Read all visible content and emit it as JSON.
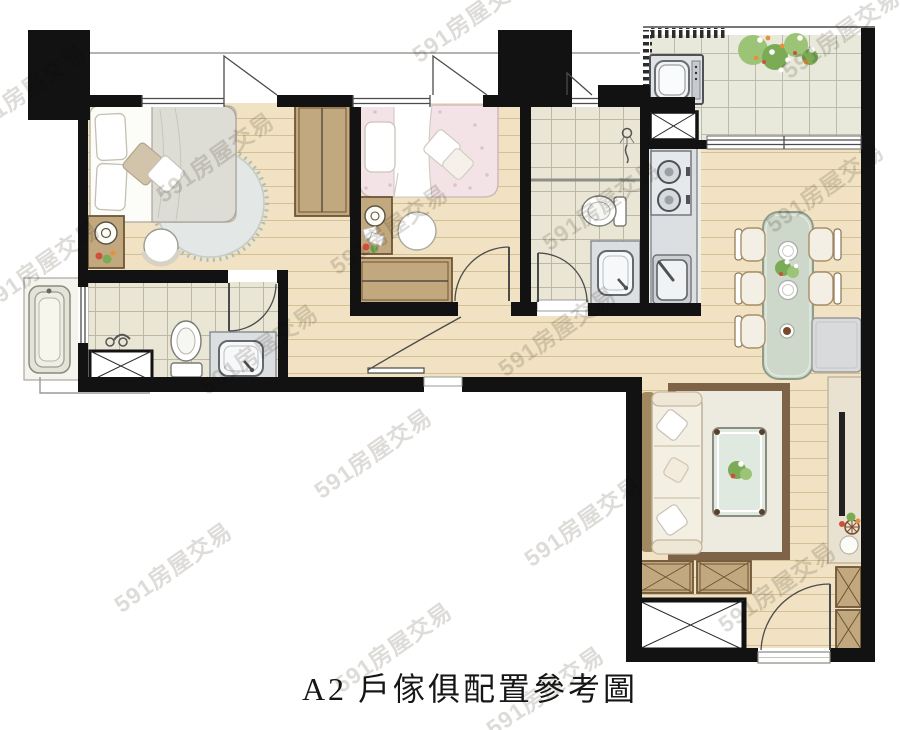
{
  "caption": "A2 戶傢俱配置參考圖",
  "watermark": {
    "text": "591房屋交易"
  },
  "palette": {
    "wall": "#121212",
    "line": "#4b4b4b",
    "thin": "#9b9a92",
    "wood": "#f0e2c2",
    "woodline": "#d5bf94",
    "tile": "#eae6d6",
    "tileline": "#bdb8a2",
    "btile": "#e9e9db",
    "btileline": "#bcbca9",
    "cabinet": "#c2a87e",
    "cabinetdark": "#6e5636",
    "fixture": "#dcdfe2",
    "fixedge": "#85898d",
    "bedwhite": "#fcfcf9",
    "blanket": "#ddddd5",
    "pinkbed": "#f3e3e6",
    "ruground": "#e3e8e6",
    "rugroundedge": "#afbcb8",
    "sofaframe": "#a0885f",
    "sofaseat": "#f4efe3",
    "livingrug": "#edeae0",
    "livingrugedge": "#7e6347",
    "glass": "#dfe9df",
    "diningtable": "#cdd7ca",
    "diningedge": "#8f9c8a",
    "chair": "#f3efe4",
    "chairedge": "#a98f68",
    "green": "#7cab55",
    "green2": "#9cc477",
    "orange": "#e2913f",
    "red": "#cf4f3f",
    "stone": "#e9e2d0",
    "watermark": "#bdbab3"
  }
}
